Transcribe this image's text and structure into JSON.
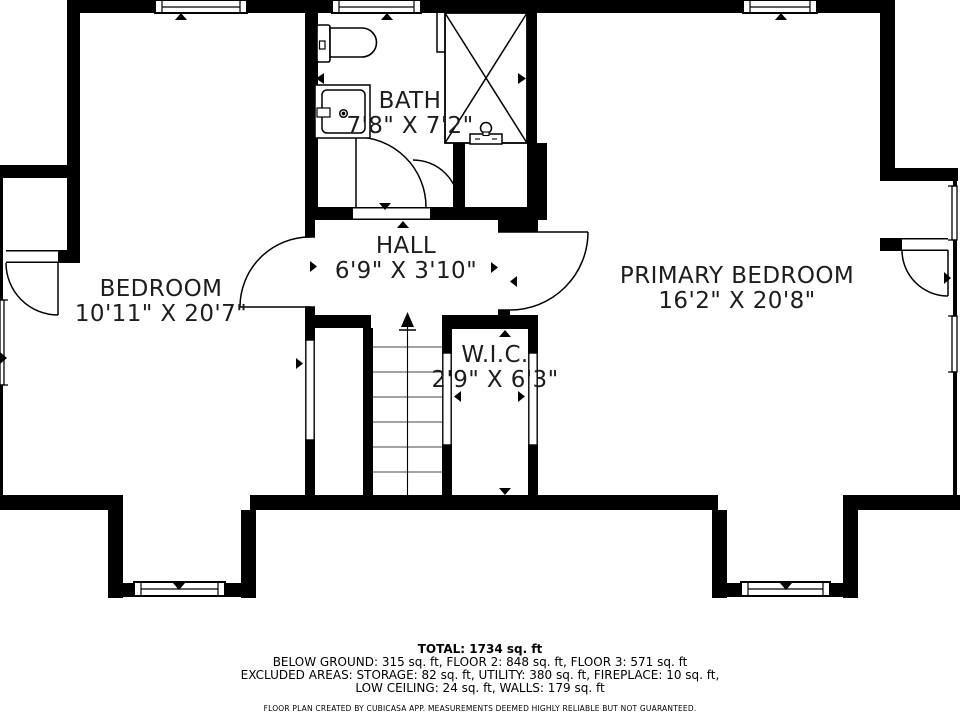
{
  "colors": {
    "wall": "#000000",
    "background": "#ffffff",
    "text": "#1d1d1d"
  },
  "rooms": [
    {
      "id": "bath",
      "name": "BATH",
      "dims": "7'8\" X 7'2\""
    },
    {
      "id": "hall",
      "name": "HALL",
      "dims": "6'9\" X 3'10\""
    },
    {
      "id": "bedroom",
      "name": "BEDROOM",
      "dims": "10'11\" X 20'7\""
    },
    {
      "id": "wic",
      "name": "W.I.C.",
      "dims": "2'9\" X 6'3\""
    },
    {
      "id": "primary-bedroom",
      "name": "PRIMARY BEDROOM",
      "dims": "16'2\" X 20'8\""
    }
  ],
  "summary": {
    "total": "TOTAL: 1734 sq. ft",
    "line2": "BELOW GROUND: 315 sq. ft, FLOOR 2: 848 sq. ft, FLOOR 3: 571 sq. ft",
    "line3": "EXCLUDED AREAS: STORAGE: 82 sq. ft, UTILITY: 380 sq. ft, FIREPLACE: 10 sq. ft,",
    "line4": "LOW CEILING: 24 sq. ft, WALLS: 179 sq. ft",
    "disclaimer": "FLOOR PLAN CREATED BY CUBICASA APP. MEASUREMENTS DEEMED HIGHLY RELIABLE BUT NOT GUARANTEED."
  }
}
